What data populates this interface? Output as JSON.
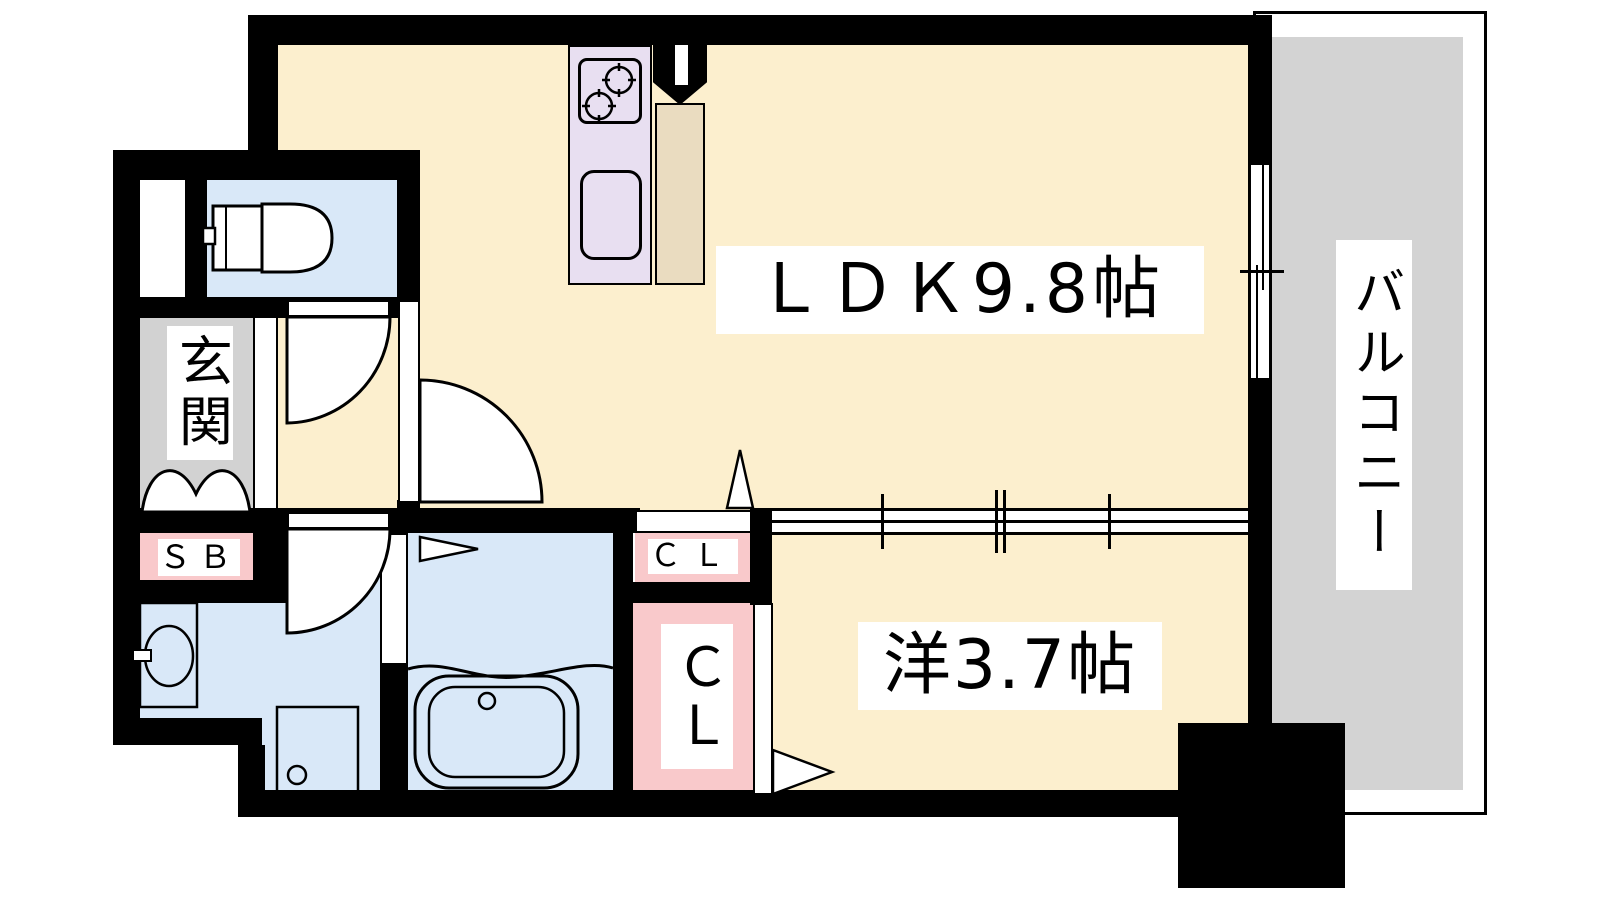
{
  "plan_title": "1LDK apartment floor plan",
  "labels": {
    "ldk": "ＬＤＫ9.8帖",
    "western_room": "洋3.7帖",
    "balcony": "バルコニー",
    "entrance": "玄関",
    "shoe_box": "ＳＢ",
    "closet_small": "ＣＬ",
    "closet_large": "ＣＬ"
  },
  "colors": {
    "wall": "#000000",
    "floor_cream": "#FCEFCE",
    "wet_area_blue": "#D9E8F8",
    "kitchen_lavender": "#E8DFF1",
    "refrigerator_beige": "#EADCC0",
    "closet_pink": "#F9C9CB",
    "entrance_gray": "#D2D2D2",
    "balcony_gray": "#D3D3D3",
    "label_bg": "#FFFFFF"
  },
  "fixtures": [
    "toilet-icon",
    "stove-burners-icon",
    "kitchen-sink-icon",
    "refrigerator-space",
    "vanity-sink-icon",
    "washing-machine-pan-icon",
    "bathtub-icon",
    "entrance-door-arcs",
    "door-swing-arc",
    "sliding-window",
    "sliding-partition",
    "closet-door-triangle"
  ]
}
